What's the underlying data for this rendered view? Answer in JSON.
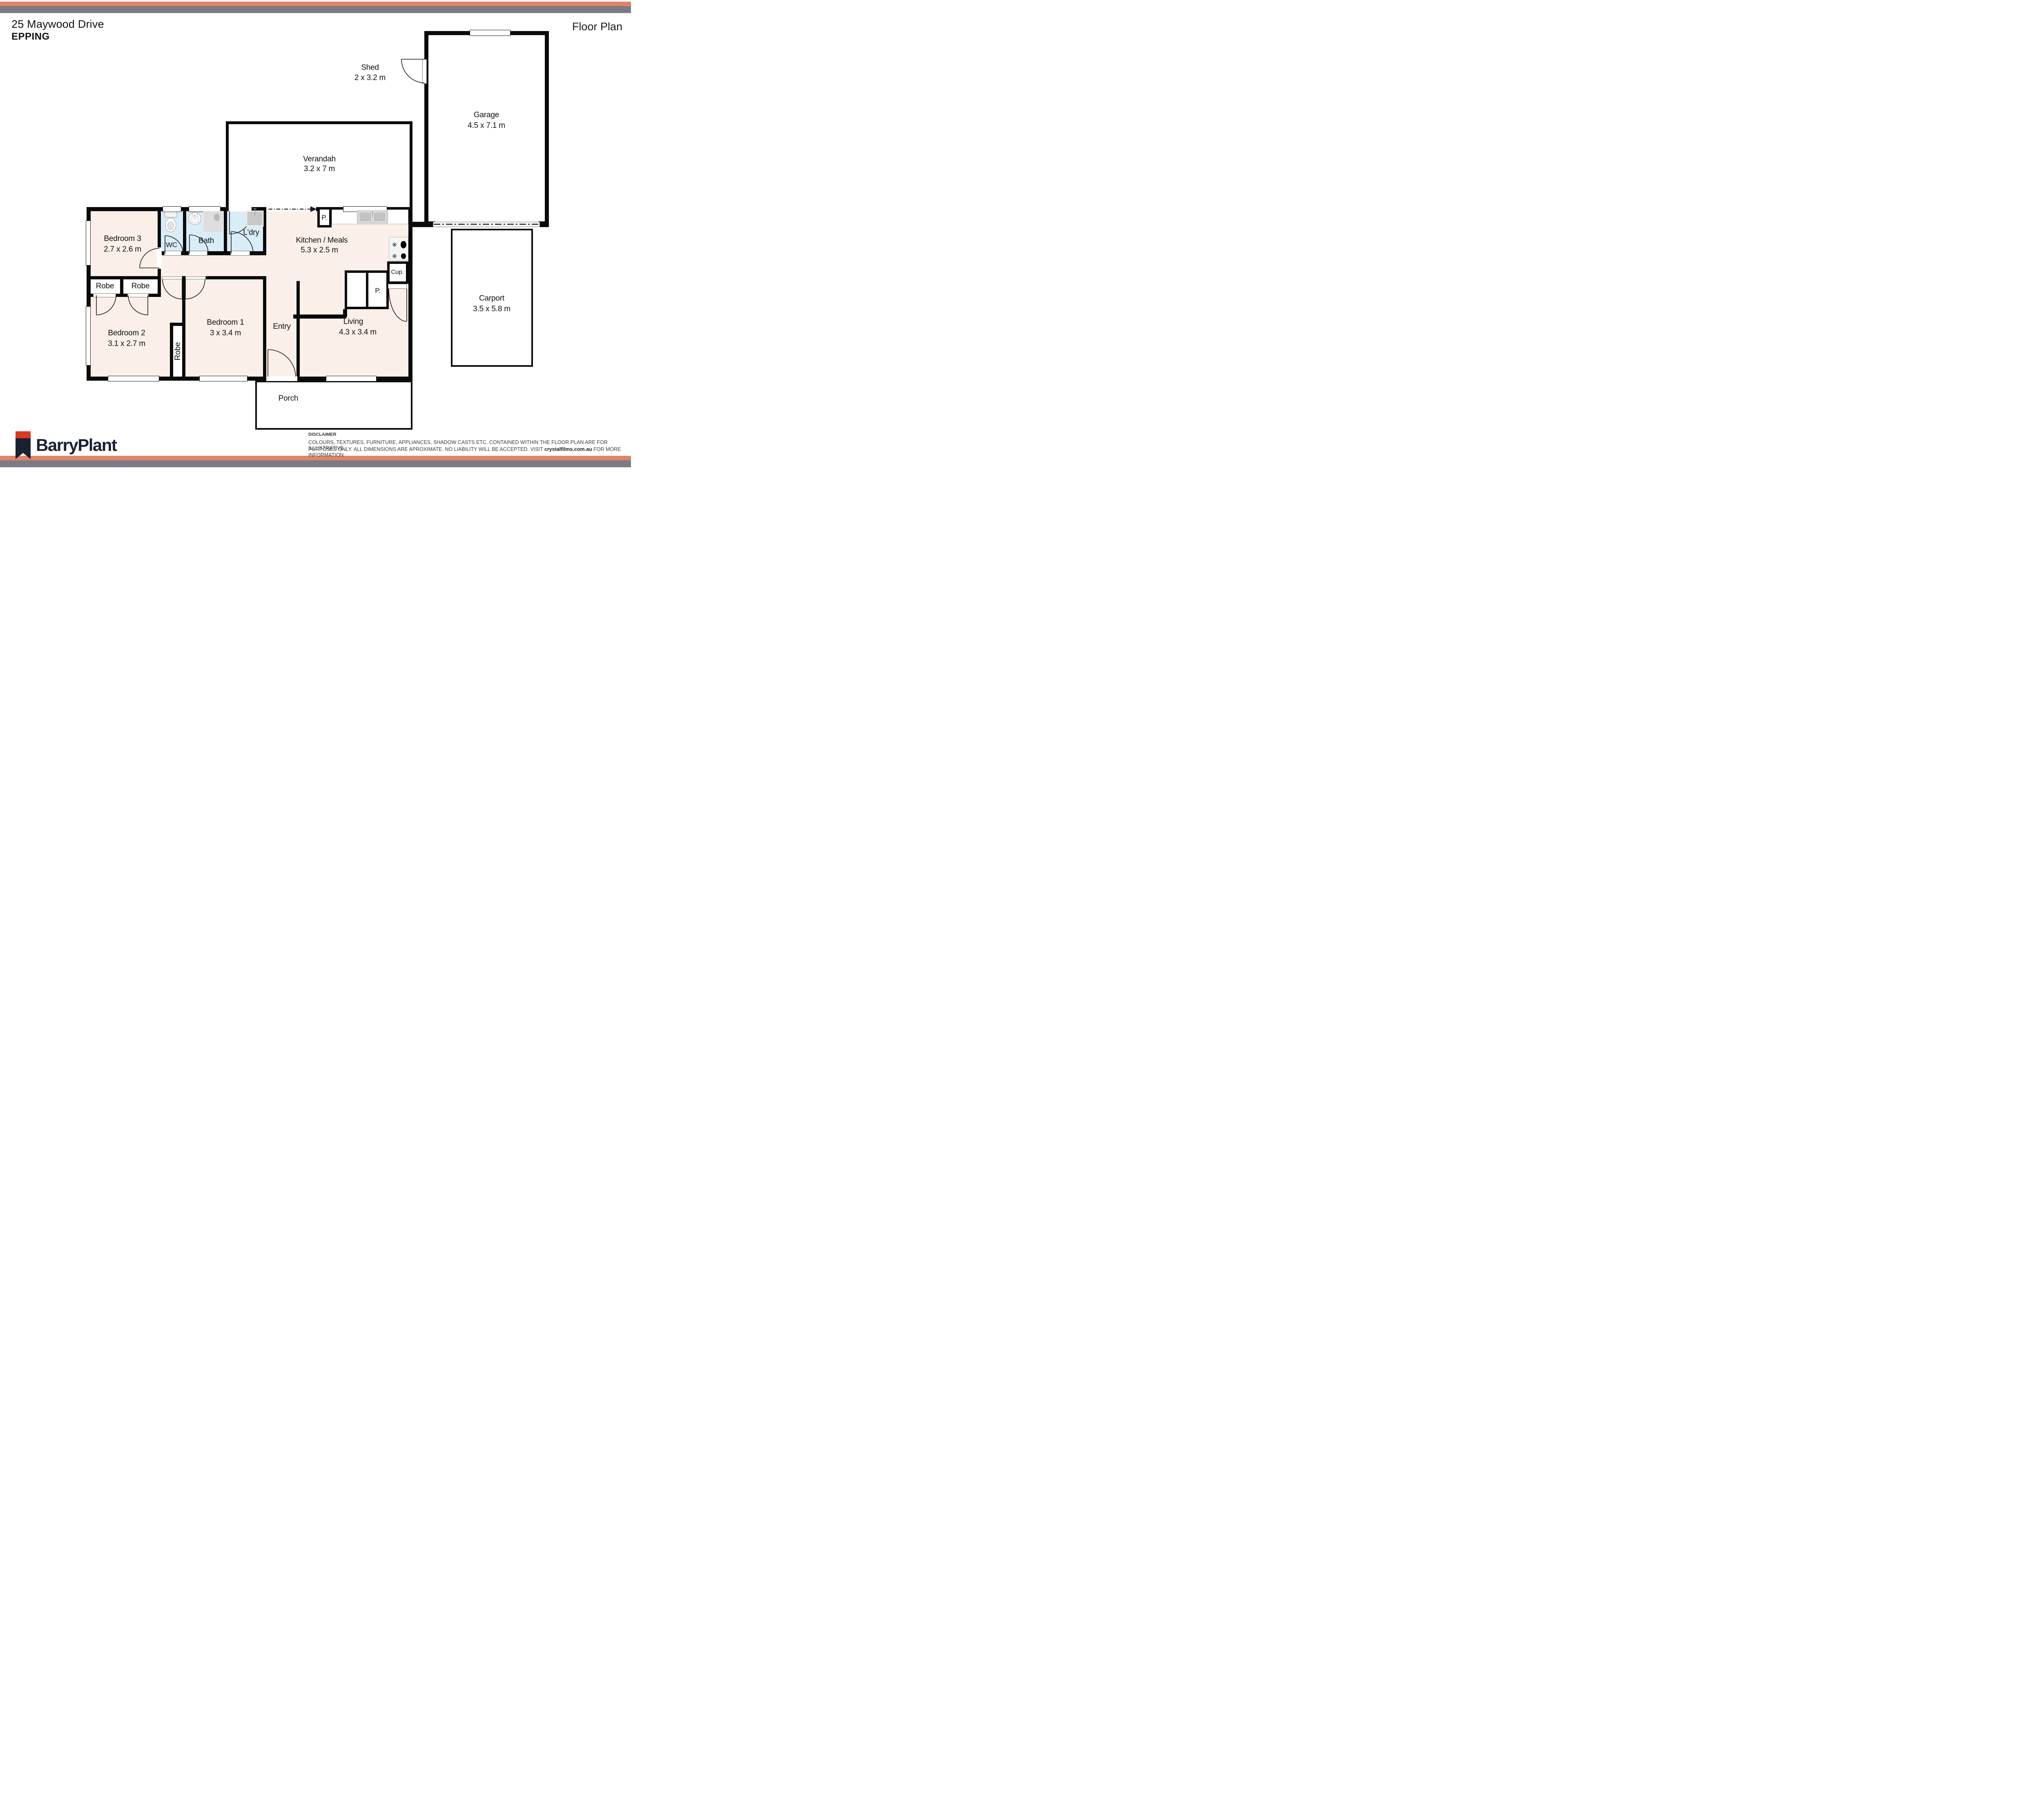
{
  "header": {
    "address": "25 Maywood Drive",
    "suburb": "EPPING",
    "plan_title": "Floor Plan"
  },
  "rooms": {
    "shed": {
      "name": "Shed",
      "dims": "2 x 3.2 m"
    },
    "garage": {
      "name": "Garage",
      "dims": "4.5 x 7.1 m"
    },
    "verandah": {
      "name": "Verandah",
      "dims": "3.2 x 7 m"
    },
    "carport": {
      "name": "Carport",
      "dims": "3.5 x 5.8 m"
    },
    "kitchen": {
      "name": "Kitchen / Meals",
      "dims": "5.3 x 2.5 m"
    },
    "living": {
      "name": "Living",
      "dims": "4.3 x 3.4 m"
    },
    "bedroom1": {
      "name": "Bedroom 1",
      "dims": "3 x 3.4 m"
    },
    "bedroom2": {
      "name": "Bedroom 2",
      "dims": "3.1 x 2.7 m"
    },
    "bedroom3": {
      "name": "Bedroom 3",
      "dims": "2.7 x 2.6 m"
    },
    "bath": {
      "name": "Bath"
    },
    "wc": {
      "name": "WC"
    },
    "laundry": {
      "name": "L'dry"
    },
    "entry": {
      "name": "Entry"
    },
    "porch": {
      "name": "Porch"
    }
  },
  "closets": {
    "robe1": "Robe",
    "robe2": "Robe",
    "robe3": "Robe"
  },
  "cabinets": {
    "pantry_top": "P.",
    "pantry_bottom": "P.",
    "cupboard": "Cup."
  },
  "fixtures": [
    "toilet",
    "bath-basin",
    "shower",
    "laundry-tub",
    "kitchen-sink",
    "stove-cooktop"
  ],
  "footer": {
    "brand": "BarryPlant",
    "disclaimer_title": "DISCLAIMER",
    "disclaimer_line1": "COLOURS, TEXTURES, FURNITURE, APPLIANCES, SHADOW CASTS ETC. CONTAINED WITHIN THE FLOOR PLAN ARE FOR ILLUSTRATIVE",
    "disclaimer_line2_pre": "PURPOSES ONLY. ALL DIMENSIONS ARE APROXIMATE. NO LIABILITY WILL BE ACCEPTED. VISIT ",
    "disclaimer_link": "crystalfilms.com.au",
    "disclaimer_line2_post": " FOR MORE INFORMATION"
  },
  "colors": {
    "accent_salmon": "#E08468",
    "bar_gray": "#7C7B85",
    "floor_pink": "#FBF0E9",
    "wet_blue": "#D9EDF8",
    "wall_black": "#0A0A0A",
    "logo_navy": "#1B2133",
    "logo_red": "#D93A21"
  }
}
